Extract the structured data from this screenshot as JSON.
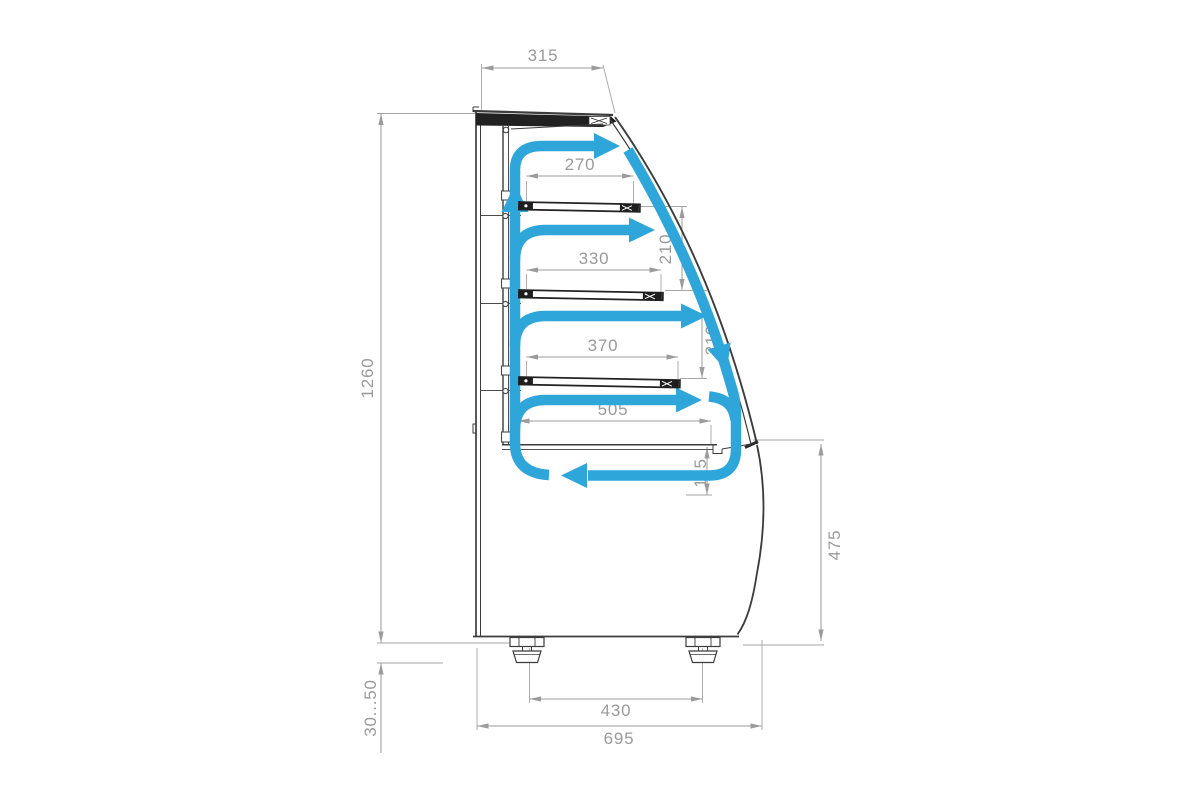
{
  "diagram": {
    "title": "Refrigerated display case side cross-section with air circulation",
    "type": "technical-drawing",
    "colors": {
      "airflow_blue": "#2fa6da",
      "outline_dark": "#3c3c3c",
      "dimension_gray": "#9b9b9b",
      "background": "#ffffff"
    },
    "labels": {
      "top_width": "315",
      "overall_height": "1260",
      "foot_adjust_range": "30...50",
      "shelf1_width": "270",
      "shelf2_width": "330",
      "shelf3_width": "370",
      "deck_width": "505",
      "shelf_gap_upper": "210",
      "shelf_gap_lower": "210",
      "well_depth": "115",
      "base_height": "475",
      "foot_span": "430",
      "overall_depth": "695"
    },
    "airflow": {
      "color": "#2fa6da",
      "segments": [
        "back-wall-riser-up",
        "top-discharge-right",
        "shelf-gap-discharge-1",
        "shelf-gap-discharge-2",
        "shelf-gap-discharge-3",
        "curved-glass-downflow",
        "bottom-return-left"
      ]
    }
  }
}
